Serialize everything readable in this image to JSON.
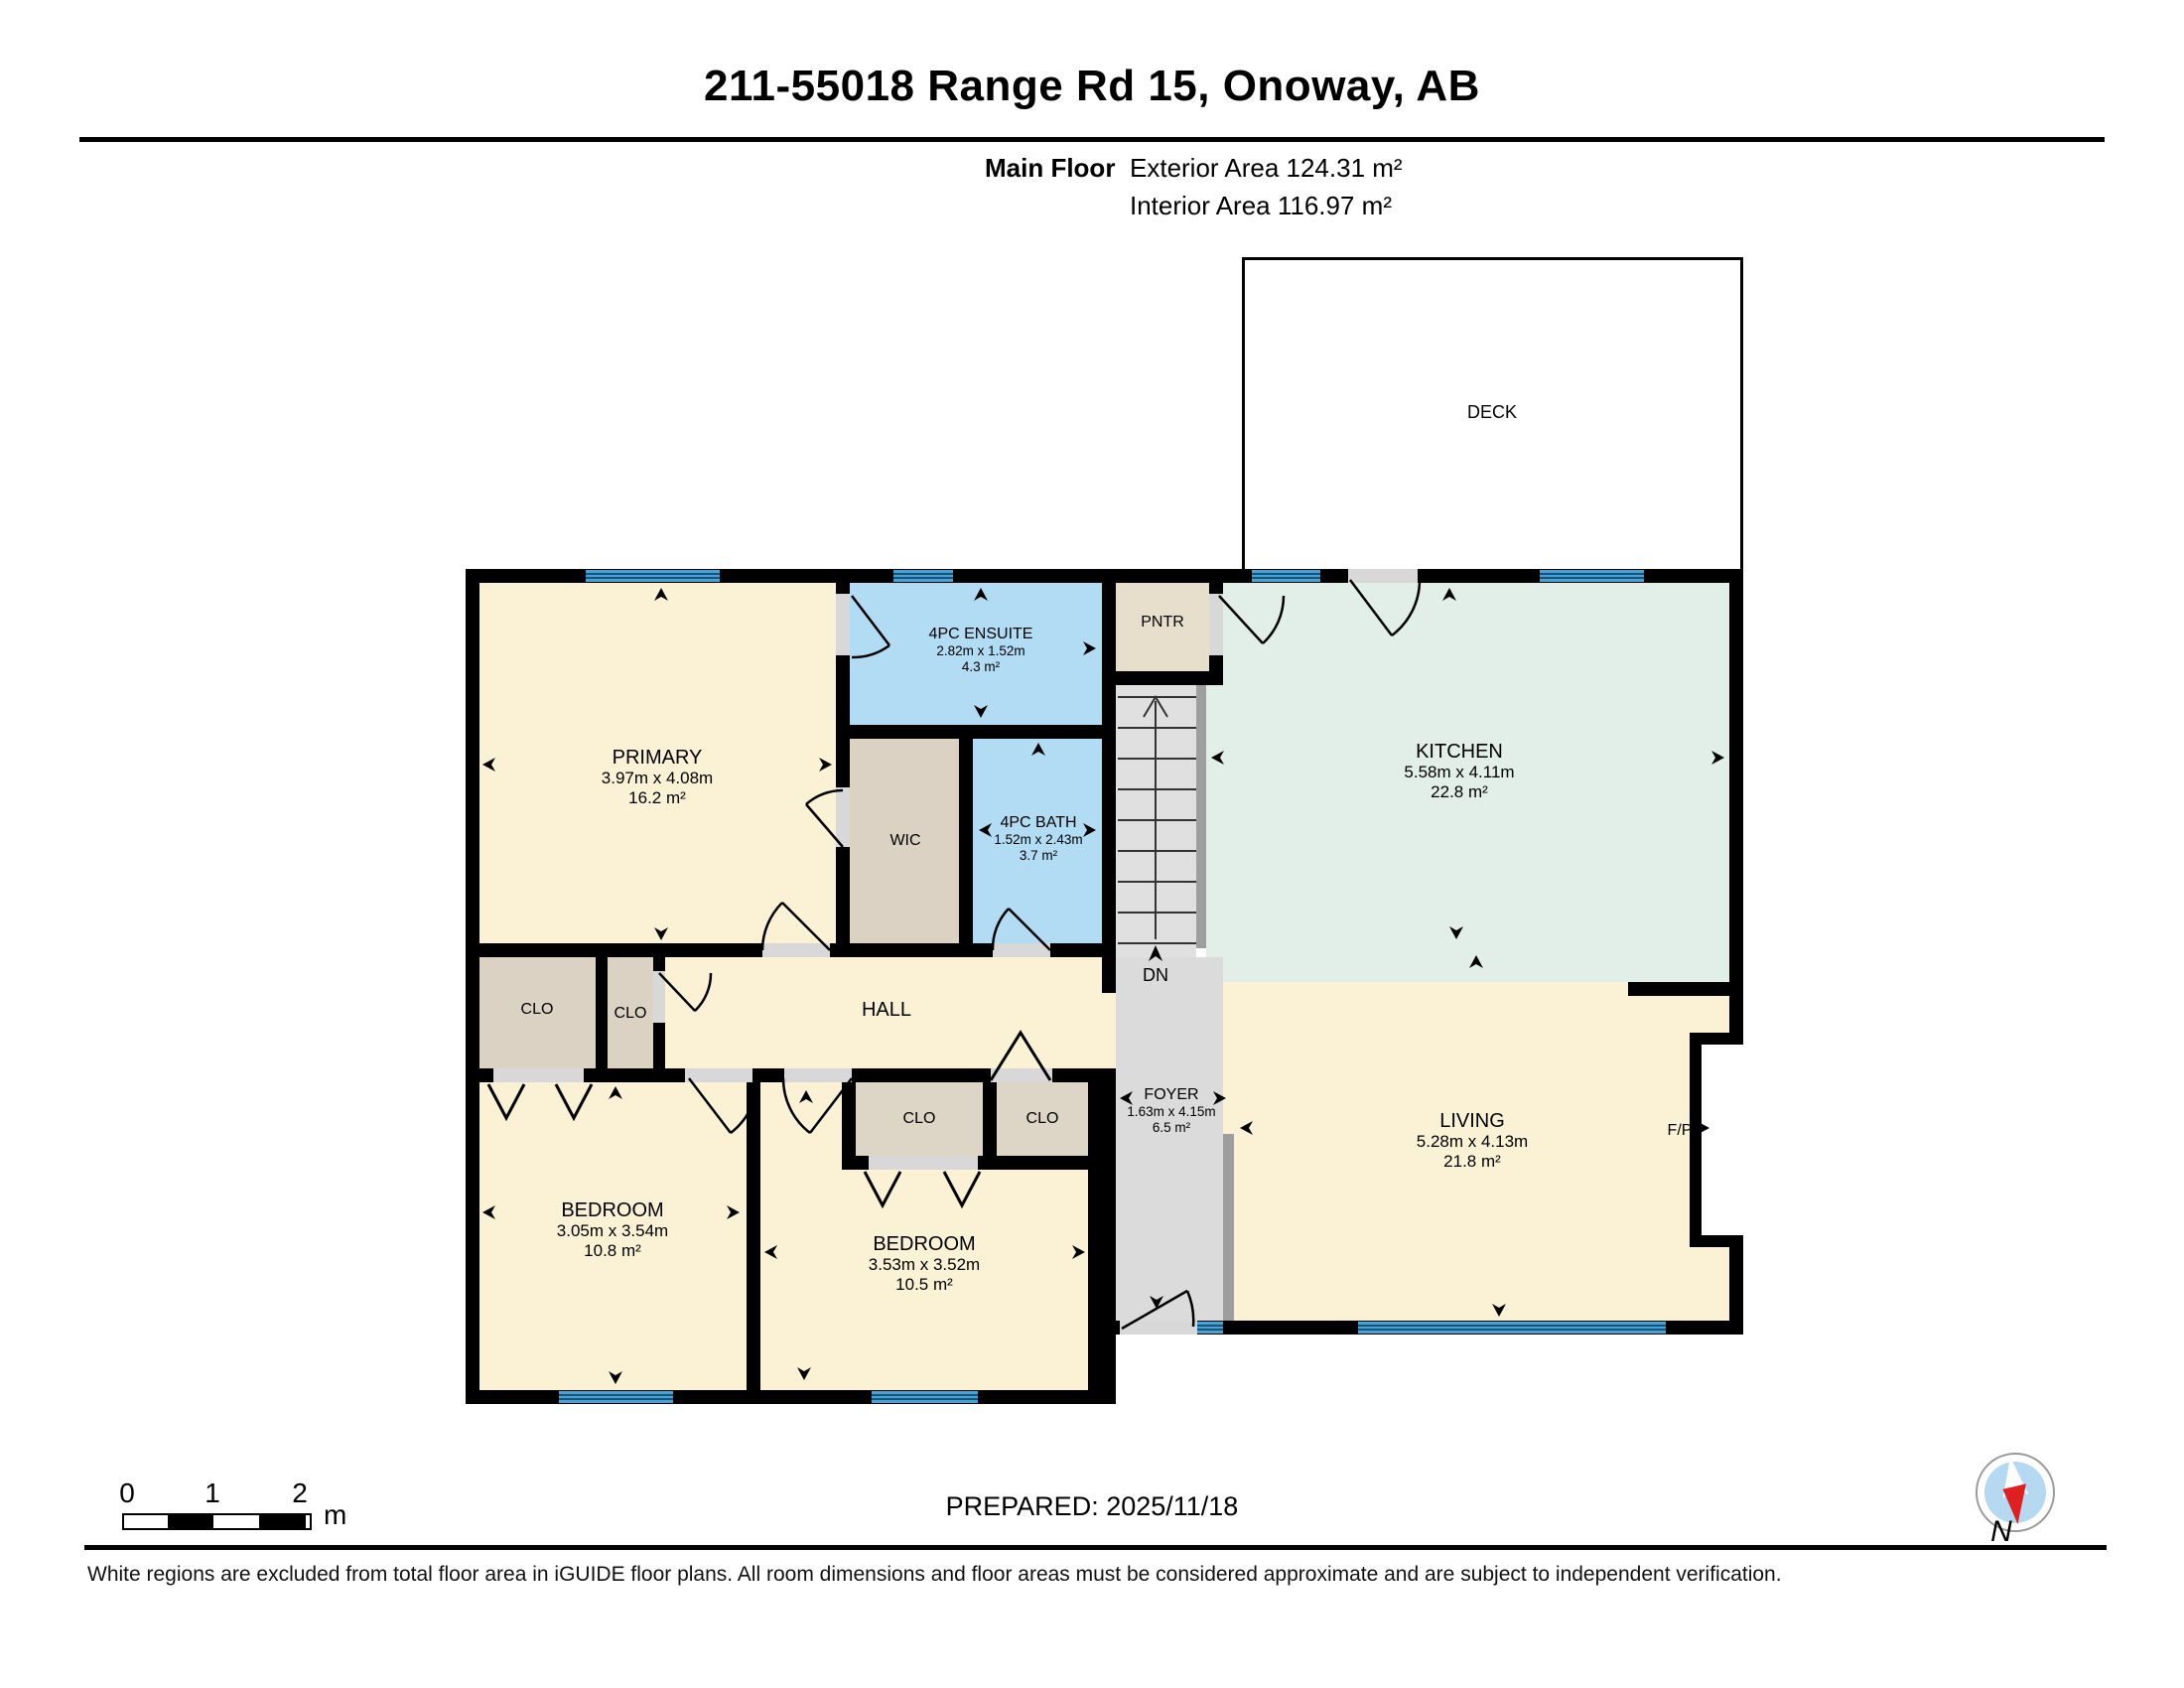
{
  "header": {
    "title": "211-55018 Range Rd 15, Onoway, AB",
    "floor_label": "Main Floor",
    "exterior_area": "Exterior Area 124.31 m²",
    "interior_area": "Interior Area 116.97 m²"
  },
  "rooms": {
    "deck": {
      "name": "DECK"
    },
    "primary": {
      "name": "PRIMARY",
      "dims": "3.97m x 4.08m",
      "area": "16.2 m²"
    },
    "ensuite": {
      "name": "4PC ENSUITE",
      "dims": "2.82m x 1.52m",
      "area": "4.3 m²"
    },
    "wic": {
      "name": "WIC"
    },
    "bath": {
      "name": "4PC BATH",
      "dims": "1.52m x 2.43m",
      "area": "3.7 m²"
    },
    "pantry": {
      "name": "PNTR"
    },
    "kitchen": {
      "name": "KITCHEN",
      "dims": "5.58m x 4.11m",
      "area": "22.8 m²"
    },
    "hall": {
      "name": "HALL"
    },
    "closet1": {
      "name": "CLO"
    },
    "closet2": {
      "name": "CLO"
    },
    "closet3": {
      "name": "CLO"
    },
    "closet4": {
      "name": "CLO"
    },
    "foyer": {
      "name": "FOYER",
      "dims": "1.63m x 4.15m",
      "area": "6.5 m²"
    },
    "living": {
      "name": "LIVING",
      "dims": "5.28m x 4.13m",
      "area": "21.8 m²"
    },
    "fireplace": {
      "name": "F/P"
    },
    "bedroom1": {
      "name": "BEDROOM",
      "dims": "3.05m x 3.54m",
      "area": "10.8 m²"
    },
    "bedroom2": {
      "name": "BEDROOM",
      "dims": "3.53m x 3.52m",
      "area": "10.5 m²"
    },
    "stairs": {
      "down_label": "DN"
    }
  },
  "scale_bar": {
    "ticks": [
      "0",
      "1",
      "2"
    ],
    "unit": "m"
  },
  "footer": {
    "prepared": "PREPARED: 2025/11/18",
    "compass_label": "N",
    "disclaimer": "White regions are excluded from total floor area in iGUIDE floor plans. All room dimensions and floor areas must be considered approximate and are subject to independent verification."
  },
  "colors": {
    "wall": "#000000",
    "room_cream": "#FBF2D6",
    "room_blue": "#B2DCF4",
    "room_green": "#E2EFE8",
    "closet_tan": "#DBD2C3",
    "stair_grey": "#E0E0E0",
    "window_blue": "#4AA1D4",
    "compass_red": "#E02020"
  }
}
